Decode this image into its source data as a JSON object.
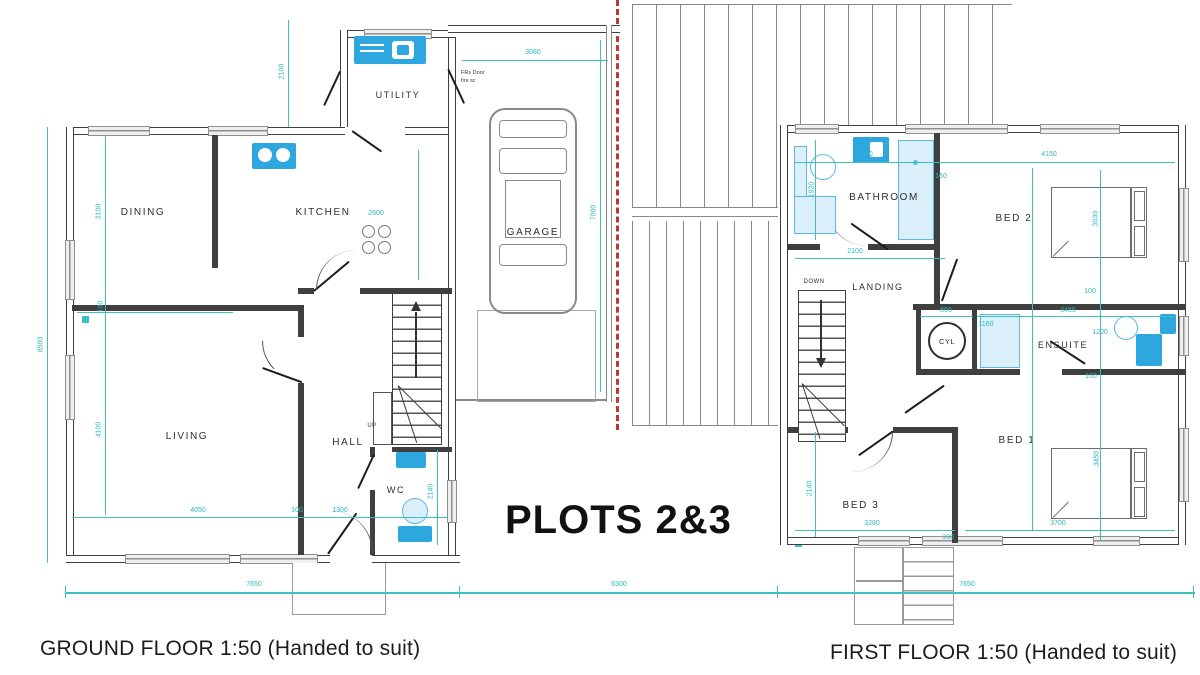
{
  "title": {
    "plots": "PLOTS 2&3"
  },
  "captions": {
    "ground": "GROUND FLOOR  1:50 (Handed to suit)",
    "first": "FIRST FLOOR  1:50 (Handed to suit)"
  },
  "ground": {
    "rooms": {
      "dining": "DINING",
      "kitchen": "KITCHEN",
      "utility": "UTILITY",
      "garage": "GARAGE",
      "living": "LIVING",
      "hall": "HALL",
      "wc": "WC"
    },
    "stairs": {
      "direction": "UP"
    },
    "note": {
      "line1": "FRs Door",
      "line2": "fire sc"
    },
    "dims": {
      "utility_depth": "2100",
      "garage_width": "3080",
      "garage_depth": "7000",
      "house_depth": "8500",
      "dining_depth": "3100",
      "wall": "100",
      "living_depth": "4100",
      "kitchen_units": "2600",
      "living_width": "4050",
      "wall2": "100",
      "hall_width": "1300",
      "wc_depth": "2140",
      "overall_width": "7650"
    }
  },
  "site": {
    "plot_gap": "6300"
  },
  "first": {
    "rooms": {
      "bathroom": "BATHROOM",
      "bed2": "BED 2",
      "landing": "LANDING",
      "cyl": "CYL",
      "ensuite": "ENSUITE",
      "bed1": "BED 1",
      "bed3": "BED 3"
    },
    "stairs": {
      "direction": "DOWN"
    },
    "dims": {
      "bathroom_width": "2080",
      "offset": "160",
      "bed2_width": "4150",
      "bathroom_depth": "1920",
      "bed2_depth": "3030",
      "landing_width": "2100",
      "wall_a": "100",
      "cyl_width": "865",
      "ensuite_width": "3455",
      "shower_width": "1160",
      "ensuite_depth": "1200",
      "wall_b": "100",
      "bed3_depth": "2140",
      "bed3_width": "3280",
      "wall_c": "100",
      "bed1_width": "3700",
      "bed1_depth": "3450",
      "overall_width": "7850"
    }
  },
  "colors": {
    "dimension_cyan": "#3fc0c0",
    "fixture_blue": "#2da7dd",
    "fixture_pale": "#daeffa",
    "wall_dark": "#3f3f3f",
    "party_wall_red": "#bf3a2e",
    "hatch_gray": "#8a8a8a",
    "window_gray": "#efefef"
  }
}
